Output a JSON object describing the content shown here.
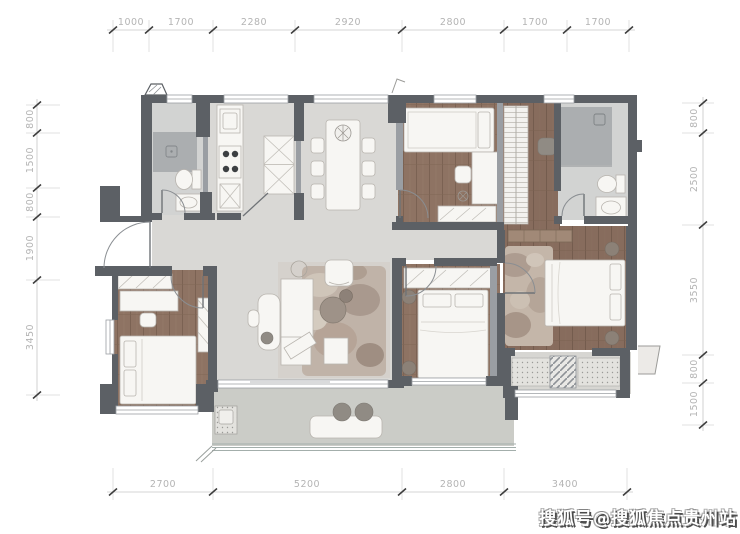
{
  "watermark": {
    "text": "搜狐号@搜狐焦点贵州站"
  },
  "dimensions": {
    "top": [
      "1000",
      "1700",
      "2280",
      "2920",
      "2800",
      "1700",
      "1700"
    ],
    "bottom": [
      "2700",
      "5200",
      "2800",
      "3400"
    ],
    "left": [
      "800",
      "1500",
      "800",
      "1900",
      "3450"
    ],
    "right": [
      "800",
      "2500",
      "3550",
      "800",
      "1500"
    ]
  },
  "colors": {
    "wall": "#5c6065",
    "wall_thin": "#9a9ea3",
    "wood_floor": "#8e7363",
    "wood_floor_master": "#876c5d",
    "tile_floor": "#d9d8d5",
    "bath_tile": "#d2d3d2",
    "shower": "#abaeb0",
    "balcony": "#cbccc7",
    "furniture": "#f7f6f3",
    "dim_text": "#b4b4b4",
    "watermark_text": "#ffffff"
  }
}
